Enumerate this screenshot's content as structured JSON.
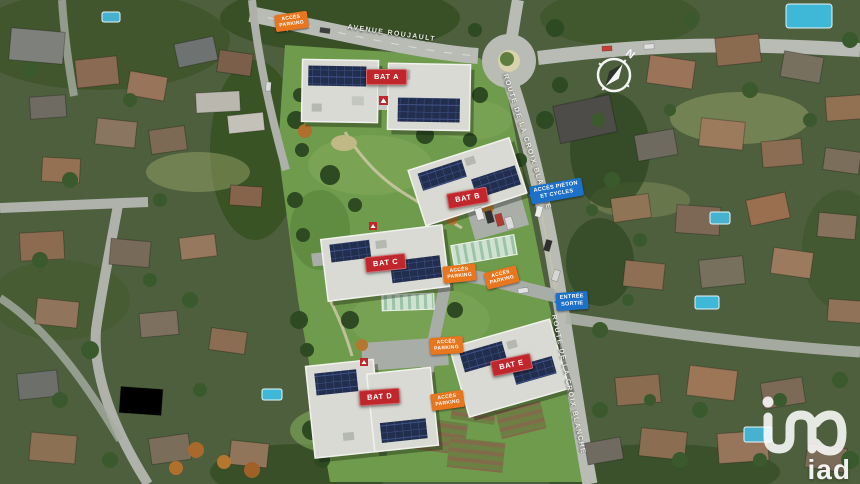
{
  "streets": {
    "avenue": "AVENUE ROUJAULT",
    "route_upper": "ROUTE DE LA CROIX BLANCHE",
    "route_lower": "ROUTE DE LA CROIX BLANCHE"
  },
  "buildings": [
    {
      "label": "BAT A"
    },
    {
      "label": "BAT B"
    },
    {
      "label": "BAT C"
    },
    {
      "label": "BAT D"
    },
    {
      "label": "BAT E"
    }
  ],
  "access_badges": [
    {
      "line1": "ACCÈS",
      "line2": "PARKING"
    },
    {
      "line1": "ACCÈS",
      "line2": "PARKING"
    },
    {
      "line1": "ACCÈS",
      "line2": "PARKING"
    },
    {
      "line1": "ACCÈS",
      "line2": "PARKING"
    },
    {
      "line1": "ACCÈS",
      "line2": "PARKING"
    }
  ],
  "circulation_badges": [
    {
      "line1": "ACCÈS PIÉTON",
      "line2": "ET CYCLES"
    },
    {
      "line1": "ENTRÉE",
      "line2": "SORTIE"
    }
  ],
  "compass": {
    "north": "N"
  },
  "logo": {
    "brand": "iad"
  },
  "colors": {
    "building_badge": "#c0272d",
    "access_badge": "#e8761e",
    "circulation_badge": "#1d71c8",
    "site_lawn": "#6f9b4c",
    "road": "#b8bcb4",
    "solar_panel": "#222e4e"
  }
}
